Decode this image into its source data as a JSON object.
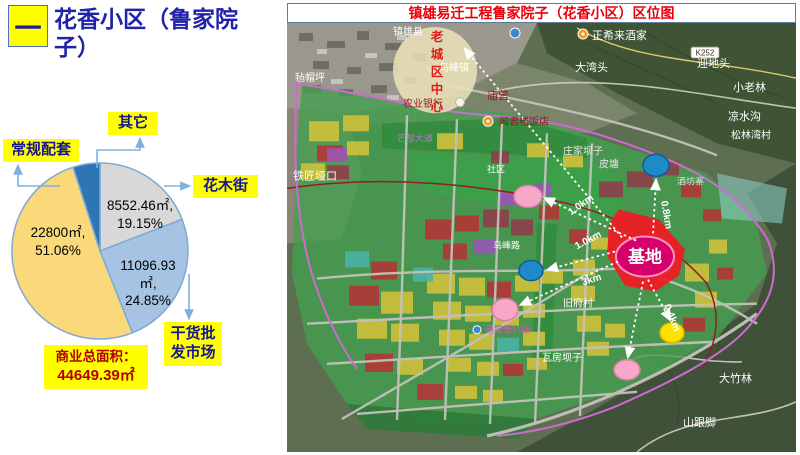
{
  "slide": {
    "badge": "一",
    "title": "花香小区（鲁家院子）"
  },
  "pie": {
    "callouts": [
      {
        "label": "其它"
      },
      {
        "label": "常规配套"
      },
      {
        "label": "花木街"
      },
      {
        "label": "干货批发市场"
      }
    ],
    "value_labels": [
      {
        "text": "8552.46㎡,\n19.15%",
        "left": 88,
        "top": 197,
        "width": 104
      },
      {
        "text": "11096.93\n㎡,\n24.85%",
        "left": 98,
        "top": 257,
        "width": 100
      },
      {
        "text": "22800㎡,\n51.06%",
        "left": 6,
        "top": 224,
        "width": 104
      }
    ],
    "total_line1": "商业总面积：",
    "total_line2": "44649.39㎡"
  },
  "chart_data": {
    "type": "pie",
    "title": "商业总面积：44649.39㎡",
    "total_area_m2": 44649.39,
    "start_angle_deg": 0,
    "direction": "clockwise",
    "slices": [
      {
        "label": "花木街",
        "area_m2": 8552.46,
        "percent": 19.15,
        "color": "#d8d8d8"
      },
      {
        "label": "干货批发市场",
        "area_m2": 11096.93,
        "percent": 24.85,
        "color": "#a6c3e3"
      },
      {
        "label": "常规配套",
        "area_m2": 22800,
        "percent": 51.06,
        "color": "#fad97a"
      },
      {
        "label": "其它",
        "area_m2": null,
        "percent": 4.94,
        "color": "#2e75b6"
      }
    ]
  },
  "map": {
    "title": "镇雄易迁工程鲁家院子（花香小区）区位图",
    "site_label": "基地",
    "old_town_label": "老城区中心",
    "road_badge": "K252",
    "labels": [
      {
        "text": "镇雄县",
        "x": 106,
        "y": 12,
        "color": "#ffffff",
        "size": 10
      },
      {
        "text": "正希来酒家",
        "x": 305,
        "y": 16,
        "color": "#ffffff",
        "size": 11
      },
      {
        "text": "大湾头",
        "x": 288,
        "y": 48,
        "color": "#ffffff",
        "size": 11
      },
      {
        "text": "迎地头",
        "x": 410,
        "y": 44,
        "color": "#ffffff",
        "size": 11
      },
      {
        "text": "小老林",
        "x": 446,
        "y": 68,
        "color": "#ffffff",
        "size": 11
      },
      {
        "text": "凉水沟",
        "x": 441,
        "y": 97,
        "color": "#ffffff",
        "size": 11
      },
      {
        "text": "松林湾村",
        "x": 444,
        "y": 115,
        "color": "#ffffff",
        "size": 10
      },
      {
        "text": "毡帽坪",
        "x": 8,
        "y": 58,
        "color": "#ffffff",
        "size": 10
      },
      {
        "text": "乌峰镇",
        "x": 152,
        "y": 48,
        "color": "#ffffff",
        "size": 10
      },
      {
        "text": "农业银行",
        "x": 116,
        "y": 84,
        "color": "#9b1b1b",
        "size": 10
      },
      {
        "text": "庙营",
        "x": 200,
        "y": 76,
        "color": "#9b1b1b",
        "size": 11
      },
      {
        "text": "闻君楼饭店",
        "x": 212,
        "y": 102,
        "color": "#8b1a1a",
        "size": 10
      },
      {
        "text": "铁匠垭口",
        "x": 6,
        "y": 156,
        "color": "#ffffff",
        "size": 11
      },
      {
        "text": "庄家坝子",
        "x": 276,
        "y": 131,
        "color": "#e8e8e8",
        "size": 10
      },
      {
        "text": "皮塘",
        "x": 312,
        "y": 144,
        "color": "#e8e8e8",
        "size": 10
      },
      {
        "text": "社区",
        "x": 200,
        "y": 149,
        "color": "#ffffff",
        "size": 9
      },
      {
        "text": "芒部大道",
        "x": 110,
        "y": 118,
        "color": "#d46ad4",
        "size": 9
      },
      {
        "text": "酒坊寨",
        "x": 390,
        "y": 161,
        "color": "#e0e0e0",
        "size": 9
      },
      {
        "text": "乌峰路",
        "x": 206,
        "y": 225,
        "color": "#ffffff",
        "size": 9
      },
      {
        "text": "旧府村",
        "x": 276,
        "y": 283,
        "color": "#ffffff",
        "size": 10
      },
      {
        "text": "易捷便利店",
        "x": 198,
        "y": 309,
        "color": "#d060a8",
        "size": 9
      },
      {
        "text": "瓦房坝子",
        "x": 255,
        "y": 337,
        "color": "#ffffff",
        "size": 10
      },
      {
        "text": "大竹林",
        "x": 432,
        "y": 358,
        "color": "#ffffff",
        "size": 11
      },
      {
        "text": "山跟脚",
        "x": 396,
        "y": 402,
        "color": "#ffffff",
        "size": 11
      }
    ],
    "distance_labels": [
      {
        "text": "1.0km",
        "x": 284,
        "y": 192,
        "rot": -35
      },
      {
        "text": "1.0km",
        "x": 290,
        "y": 226,
        "rot": -28
      },
      {
        "text": "3km",
        "x": 296,
        "y": 262,
        "rot": -18
      },
      {
        "text": "0.8km",
        "x": 374,
        "y": 178,
        "rot": 80
      },
      {
        "text": "0.4km",
        "x": 377,
        "y": 282,
        "rot": 68
      }
    ],
    "markers": [
      {
        "name": "blue-circle-north",
        "x": 369,
        "y": 142,
        "rx": 13,
        "ry": 11,
        "fill": "#1e8bc8",
        "stroke": "#0f5e8e"
      },
      {
        "name": "pink-circle-upper",
        "x": 241,
        "y": 173,
        "rx": 14,
        "ry": 11,
        "fill": "#f6a8c6",
        "stroke": "#e47ba6"
      },
      {
        "name": "blue-circle-mid",
        "x": 244,
        "y": 247,
        "rx": 12,
        "ry": 10,
        "fill": "#1e8bc8",
        "stroke": "#0f5e8e"
      },
      {
        "name": "pink-circle-mid",
        "x": 218,
        "y": 286,
        "rx": 13,
        "ry": 11,
        "fill": "#f6a8c6",
        "stroke": "#e47ba6"
      },
      {
        "name": "yellow-circle",
        "x": 385,
        "y": 309,
        "rx": 12,
        "ry": 10,
        "fill": "#ffe200",
        "stroke": "#d4b800"
      },
      {
        "name": "pink-circle-south",
        "x": 340,
        "y": 346,
        "rx": 13,
        "ry": 10,
        "fill": "#f6a8c6",
        "stroke": "#e47ba6"
      }
    ]
  }
}
